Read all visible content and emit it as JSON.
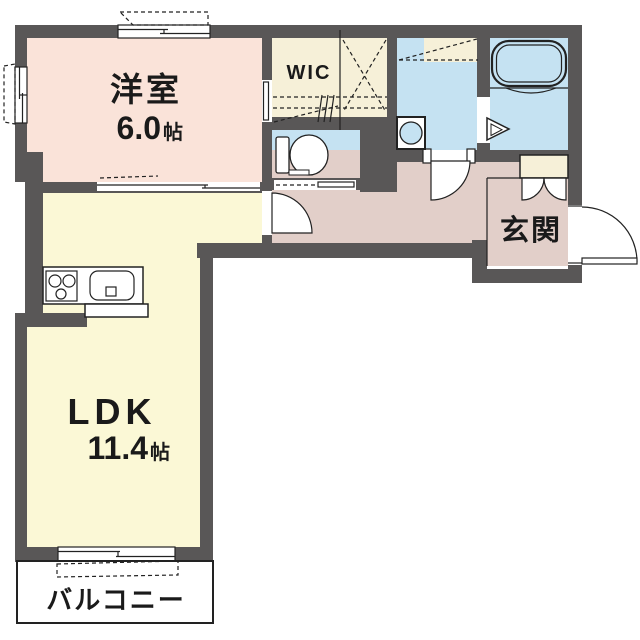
{
  "floorplan": {
    "rooms": {
      "western_room": {
        "name": "洋室",
        "size_value": "6.0",
        "size_unit": "帖"
      },
      "ldk": {
        "name": "LDK",
        "size_value": "11.4",
        "size_unit": "帖"
      },
      "wic": {
        "name": "WIC"
      },
      "entrance": {
        "name": "玄関"
      },
      "balcony": {
        "name": "バルコニー"
      }
    },
    "colors": {
      "wall": "#595757",
      "western_room_floor": "#fae3d9",
      "ldk_floor": "#fbf8d6",
      "wic_floor": "#f6f0d8",
      "wet_area_floor": "#c5e2f2",
      "hallway_floor": "#e2cfc9",
      "entrance_floor": "#e2cfc9",
      "balcony_floor": "#ffffff",
      "line": "#222222",
      "text": "#1a1a1a"
    },
    "fixtures": [
      "bathtub-icon",
      "toilet-icon",
      "washbasin-icon",
      "kitchen-stove-icon",
      "kitchen-sink-icon",
      "shoe-cabinet-icon",
      "folding-door-icon",
      "hinged-door-icon",
      "sliding-door-icon",
      "window-icon"
    ]
  }
}
